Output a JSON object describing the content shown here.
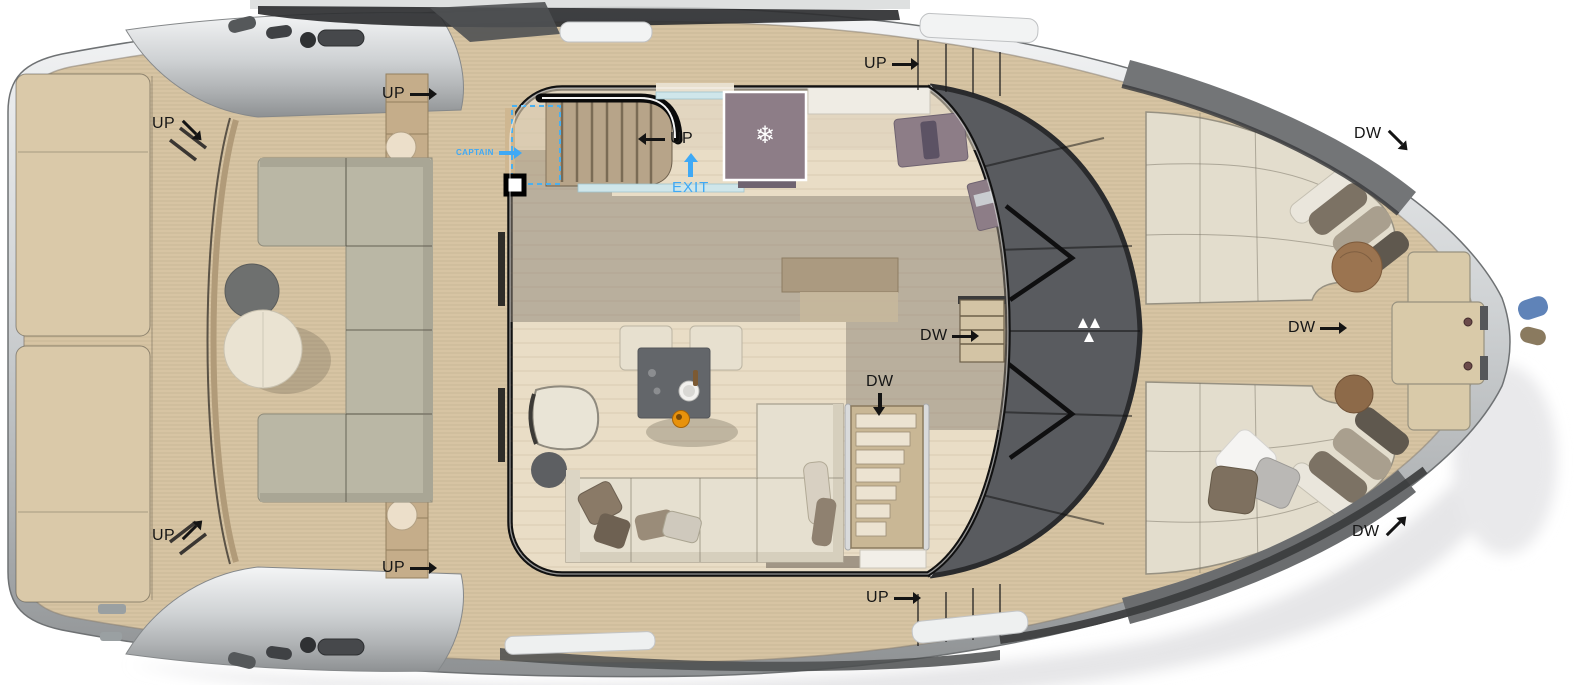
{
  "annotations": [
    {
      "id": "up-aft-port-stairs-top",
      "text": "UP",
      "arrow": "down-right"
    },
    {
      "id": "up-sidedeck-port-aft",
      "text": "UP",
      "arrow": "right"
    },
    {
      "id": "up-flybridge-stairs",
      "text": "UP",
      "arrow": "left"
    },
    {
      "id": "captain-door",
      "text": "CAPTAIN",
      "arrow": "right",
      "color": "blue"
    },
    {
      "id": "exit-door",
      "text": "EXIT",
      "arrow": "up",
      "color": "blue"
    },
    {
      "id": "up-sidedeck-port-fwd",
      "text": "UP",
      "arrow": "right"
    },
    {
      "id": "dw-foredeck-port",
      "text": "DW",
      "arrow": "down-right"
    },
    {
      "id": "dw-pilothouse-steps",
      "text": "DW",
      "arrow": "right"
    },
    {
      "id": "dw-foredeck-center",
      "text": "DW",
      "arrow": "right"
    },
    {
      "id": "dw-lower-deck-stairs",
      "text": "DW",
      "arrow": "down"
    },
    {
      "id": "dw-foredeck-starboard",
      "text": "DW",
      "arrow": "up-right"
    },
    {
      "id": "up-sidedeck-stbd-fwd",
      "text": "UP",
      "arrow": "right"
    },
    {
      "id": "up-sidedeck-stbd-aft",
      "text": "UP",
      "arrow": "right"
    },
    {
      "id": "up-aft-port-stairs-bottom",
      "text": "UP",
      "arrow": "up-right"
    }
  ],
  "icons": {
    "snowflake": "❄"
  },
  "colors": {
    "background": "#ffffff",
    "deck_teak": "#d7c4a3",
    "hull_rim_light": "#f2f3f4",
    "hull_rim_dark": "#9fa3a5",
    "salon_floor": "#e9ddc6",
    "roof_shadow_olive": "#8d8476",
    "windshield_glass": "#595b5f",
    "aft_sofa": "#bab7a5",
    "salon_sofa": "#e6e0d0",
    "foredeck_lounge": "#e3ddcd",
    "galley_mauve": "#8d7d87",
    "coffee_table": "#63666a",
    "wood_table": "#9b7450",
    "accent_blue": "#3fa9f5",
    "label_text": "#161616"
  }
}
